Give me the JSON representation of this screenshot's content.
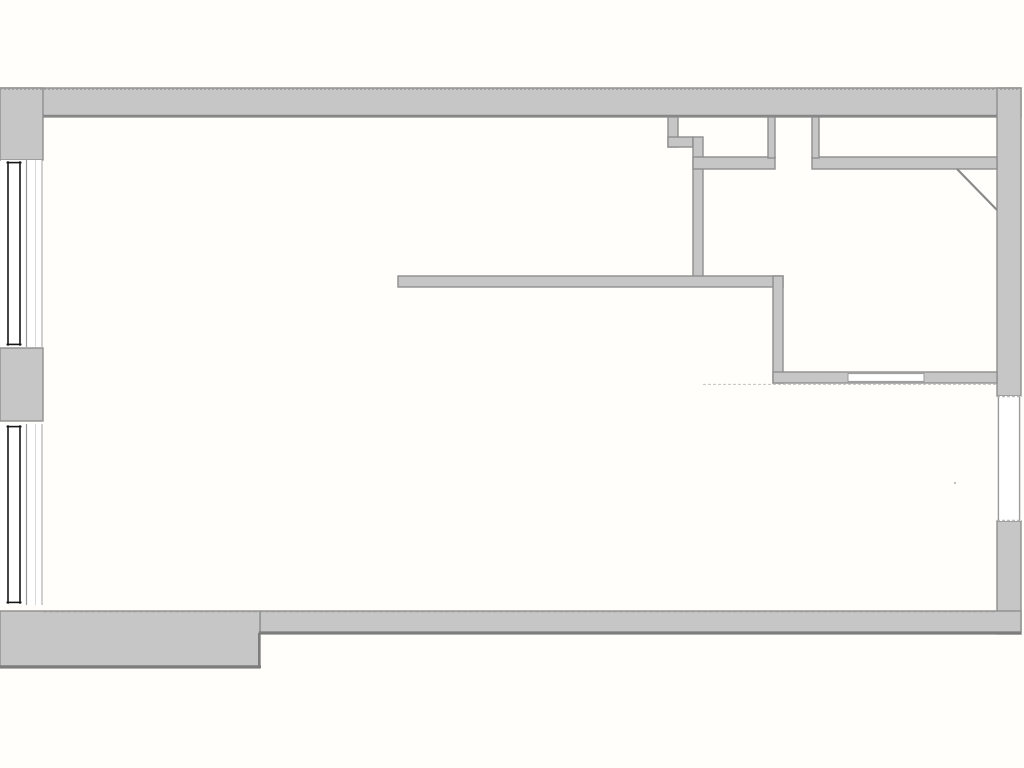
{
  "canvas": {
    "width": 1024,
    "height": 768,
    "background": "#fffefb"
  },
  "palette": {
    "wall_fill": "#c6c6c6",
    "wall_edge": "#8e8e8e",
    "dark_edge": "#7d7d7d",
    "inner_edge": "#868686",
    "outer_dash": "#a0a0a0",
    "light_dash": "#c2c2c2",
    "glazing": "#161616",
    "frame_gray": "#9a9a9a",
    "frame_light": "#d8d8d8",
    "frame_mid": "#b2b2b2",
    "white": "#ffffff",
    "door_leaf": "#8a8a8a"
  },
  "plan": {
    "walls": [
      {
        "name": "top-wall",
        "x": 0,
        "y": 88,
        "w": 1021,
        "h": 29
      },
      {
        "name": "right-wall-upper",
        "x": 997,
        "y": 88,
        "w": 24,
        "h": 308
      },
      {
        "name": "right-wall-lower",
        "x": 997,
        "y": 521,
        "w": 24,
        "h": 113
      },
      {
        "name": "bottom-wall-right",
        "x": 260,
        "y": 611,
        "w": 761,
        "h": 23
      },
      {
        "name": "bottom-wall-left",
        "x": 0,
        "y": 611,
        "w": 260,
        "h": 57
      },
      {
        "name": "left-wall-upper",
        "x": 0,
        "y": 88,
        "w": 43,
        "h": 72
      },
      {
        "name": "left-wall-pier",
        "x": 0,
        "y": 348,
        "w": 43,
        "h": 73
      },
      {
        "name": "entry-step-wall",
        "x": 668,
        "y": 117,
        "w": 10,
        "h": 30
      },
      {
        "name": "entry-step-nub",
        "x": 668,
        "y": 137,
        "w": 25,
        "h": 10
      },
      {
        "name": "entry-wall-vertical",
        "x": 693,
        "y": 137,
        "w": 10,
        "h": 141
      },
      {
        "name": "closet-band-left",
        "x": 693,
        "y": 157,
        "w": 82,
        "h": 12
      },
      {
        "name": "closet-band-right",
        "x": 812,
        "y": 157,
        "w": 185,
        "h": 12
      },
      {
        "name": "closet-divider-left",
        "x": 768,
        "y": 117,
        "w": 7,
        "h": 41
      },
      {
        "name": "closet-divider-right",
        "x": 812,
        "y": 117,
        "w": 7,
        "h": 41
      },
      {
        "name": "long-wall",
        "x": 398,
        "y": 276,
        "w": 385,
        "h": 11
      },
      {
        "name": "hall-wall-vertical",
        "x": 773,
        "y": 276,
        "w": 10,
        "h": 107
      },
      {
        "name": "room-bottom-wall",
        "x": 773,
        "y": 372,
        "w": 224,
        "h": 11
      }
    ],
    "edge_lines": [
      {
        "name": "top-wall-outer-dashed",
        "x1": 0,
        "y1": 89.3,
        "x2": 1021,
        "y2": 89.3,
        "color_key": "outer_dash",
        "width": 1.4,
        "dash": "2 2"
      },
      {
        "name": "top-wall-inner-edge",
        "x1": 43,
        "y1": 115.7,
        "x2": 997,
        "y2": 115.7,
        "color_key": "inner_edge",
        "width": 2
      },
      {
        "name": "bottom-wall-left-outer-edge",
        "x1": 0,
        "y1": 666.6,
        "x2": 261,
        "y2": 666.6,
        "color_key": "dark_edge",
        "width": 2.8
      },
      {
        "name": "bottom-wall-right-outer-edge",
        "x1": 258.8,
        "y1": 632.7,
        "x2": 1021,
        "y2": 632.7,
        "color_key": "dark_edge",
        "width": 2.6
      },
      {
        "name": "bottom-wall-step-edge",
        "x1": 259.2,
        "y1": 633,
        "x2": 259.2,
        "y2": 668,
        "color_key": "dark_edge",
        "width": 2.4
      },
      {
        "name": "bottom-wall-inner-dashed",
        "x1": 43,
        "y1": 611.6,
        "x2": 997,
        "y2": 611.6,
        "color_key": "frame_gray",
        "width": 1.2,
        "dash": "4 2"
      },
      {
        "name": "room-bottom-wall-lower-dashed",
        "x1": 703,
        "y1": 384.4,
        "x2": 997,
        "y2": 384.4,
        "color_key": "light_dash",
        "width": 1,
        "dash": "3 2"
      }
    ],
    "left_windows": {
      "strip_x": 1,
      "strip_w": 41,
      "glazing_xs": [
        8,
        20
      ],
      "cap_inset": 2.6,
      "frame_lines": [
        {
          "x": 26.5,
          "color_key": "frame_gray",
          "width": 1.2
        },
        {
          "x": 35.5,
          "color_key": "frame_light",
          "width": 1
        },
        {
          "x": 42,
          "color_key": "frame_mid",
          "width": 1.2
        }
      ],
      "instances": [
        {
          "name": "window-left-upper",
          "y1": 160,
          "y2": 347
        },
        {
          "name": "window-left-lower",
          "y1": 424,
          "y2": 605
        }
      ]
    },
    "right_window": {
      "name": "window-right-wall",
      "x": 997,
      "y": 396,
      "w": 24,
      "h": 125,
      "jamb_xs": [
        998.4,
        1019.6
      ],
      "head_dash_ys": [
        396.7,
        520.3
      ]
    },
    "interior_opening": {
      "name": "room-wall-opening",
      "x": 848,
      "y": 373.6,
      "w": 76,
      "h": 7.8
    },
    "door_leaf": {
      "name": "door-leaf-diagonal",
      "x1": 957,
      "y1": 169,
      "x2": 997,
      "y2": 210,
      "width": 2.2
    },
    "speck": {
      "name": "stray-mark",
      "x": 954,
      "y": 482,
      "w": 2,
      "h": 2,
      "color_key": "light_dash"
    }
  }
}
